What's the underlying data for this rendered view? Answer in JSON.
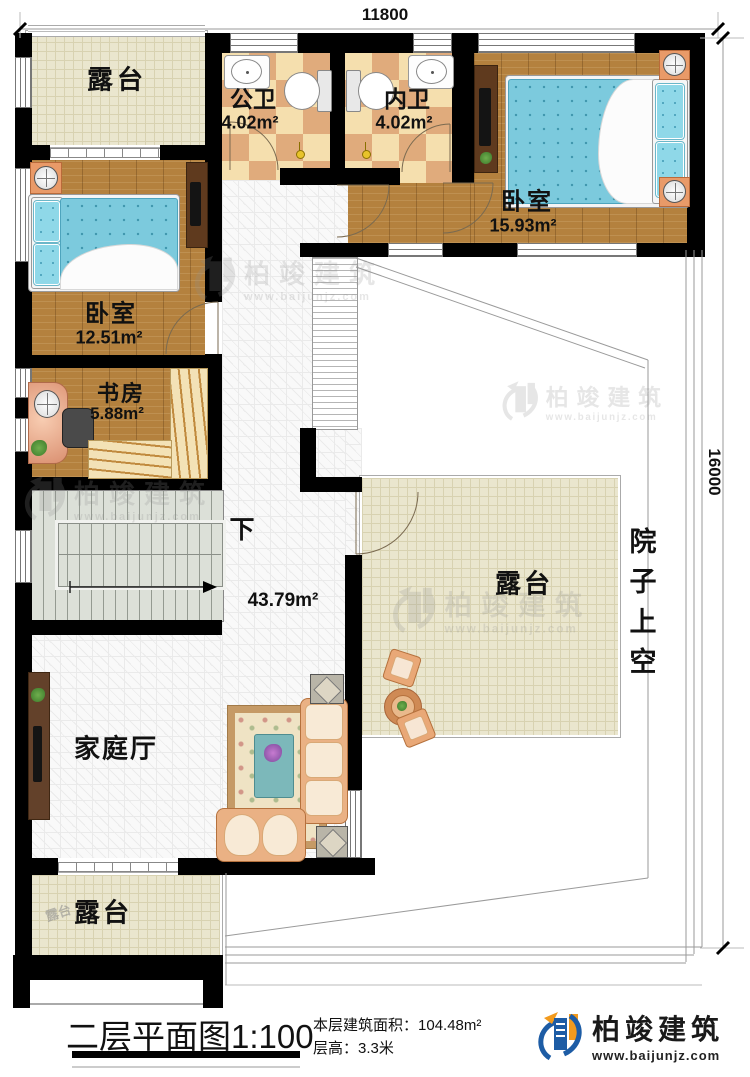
{
  "dimensions": {
    "width_label": "11800",
    "height_label": "16000"
  },
  "rooms": {
    "terrace_top_left": {
      "label": "露台"
    },
    "public_bath": {
      "label": "公卫",
      "area": "4.02m²"
    },
    "ensuite_bath": {
      "label": "内卫",
      "area": "4.02m²"
    },
    "bedroom_top_right": {
      "label": "卧室",
      "area": "15.93m²"
    },
    "bedroom_left": {
      "label": "卧室",
      "area": "12.51m²"
    },
    "study": {
      "label": "书房",
      "area": "5.88m²"
    },
    "stairs": {
      "down_label": "下"
    },
    "family_hall": {
      "label": "家庭厅",
      "area": "43.79m²"
    },
    "terrace_right": {
      "label": "露台"
    },
    "terrace_bottom": {
      "label": "露台",
      "ghost_label": "露台"
    },
    "courtyard_void": {
      "label": "院子上空"
    }
  },
  "title_block": {
    "title": "二层平面图",
    "scale": "1:100",
    "floor_area_label": "本层建筑面积：",
    "floor_area_value": "104.48m²",
    "floor_height_label": "层高：",
    "floor_height_value": "3.3米"
  },
  "brand": {
    "name": "柏竣建筑",
    "url": "www.baijunjz.com"
  },
  "colors": {
    "wall": "#000000",
    "wood": "#b4813e",
    "terrace": "#eae6ce",
    "checker_dark": "#e0ab7c",
    "checker_light": "#f5dfae",
    "brand_blue": "#1d5ca5",
    "brand_orange": "#f29a1d"
  }
}
